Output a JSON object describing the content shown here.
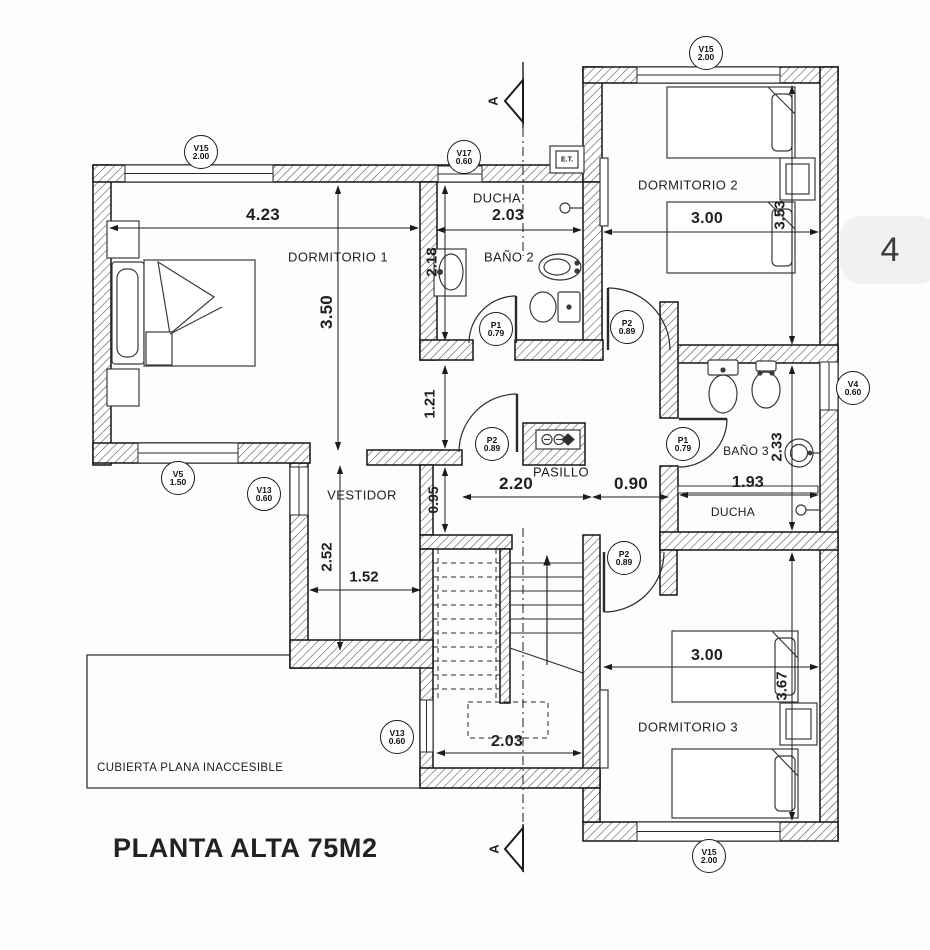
{
  "page": {
    "sheet_number": "4",
    "title": "PLANTA ALTA 75M2",
    "roof_label": "CUBIERTA PLANA INACCESIBLE",
    "et_box": "E.T.",
    "section_label_top": "A",
    "section_label_bottom": "A"
  },
  "rooms": {
    "dorm1": "DORMITORIO 1",
    "ducha2": "DUCHA",
    "bano2": "BAÑO 2",
    "dorm2": "DORMITORIO 2",
    "bano3": "BAÑO 3",
    "ducha3": "DUCHA",
    "pasillo": "PASILLO",
    "vestidor": "VESTIDOR",
    "dorm3": "DORMITORIO 3"
  },
  "dims": {
    "dorm1_w": "4.23",
    "dorm1_h": "3.50",
    "bano2_h": "2.18",
    "ducha2_w": "2.03",
    "dorm2_w": "3.00",
    "dorm2_h": "3.53",
    "nook_h": "1.21",
    "pasillo_h": "0.95",
    "pasillo_w1": "2.20",
    "pasillo_w2": "0.90",
    "bano3_w": "1.93",
    "bano3_h": "2.33",
    "dorm3_w": "3.00",
    "dorm3_h": "3.67",
    "vestidor_h": "2.52",
    "vestidor_w": "1.52",
    "stairs_w": "2.03"
  },
  "tags": {
    "v15a": {
      "code": "V15",
      "size": "2.00"
    },
    "v17": {
      "code": "V17",
      "size": "0.60"
    },
    "v15b": {
      "code": "V15",
      "size": "2.00"
    },
    "v4": {
      "code": "V4",
      "size": "0.60"
    },
    "v5": {
      "code": "V5",
      "size": "1.50"
    },
    "v13a": {
      "code": "V13",
      "size": "0.60"
    },
    "v13b": {
      "code": "V13",
      "size": "0.60"
    },
    "v15c": {
      "code": "V15",
      "size": "2.00"
    },
    "p1a": {
      "code": "P1",
      "size": "0.79"
    },
    "p2a": {
      "code": "P2",
      "size": "0.89"
    },
    "p2b": {
      "code": "P2",
      "size": "0.89"
    },
    "p1b": {
      "code": "P1",
      "size": "0.79"
    },
    "p2c": {
      "code": "P2",
      "size": "0.89"
    }
  },
  "colors": {
    "ink": "#1c1c1c",
    "paper": "#fdfdfd",
    "pill": "#f1f1f1"
  }
}
